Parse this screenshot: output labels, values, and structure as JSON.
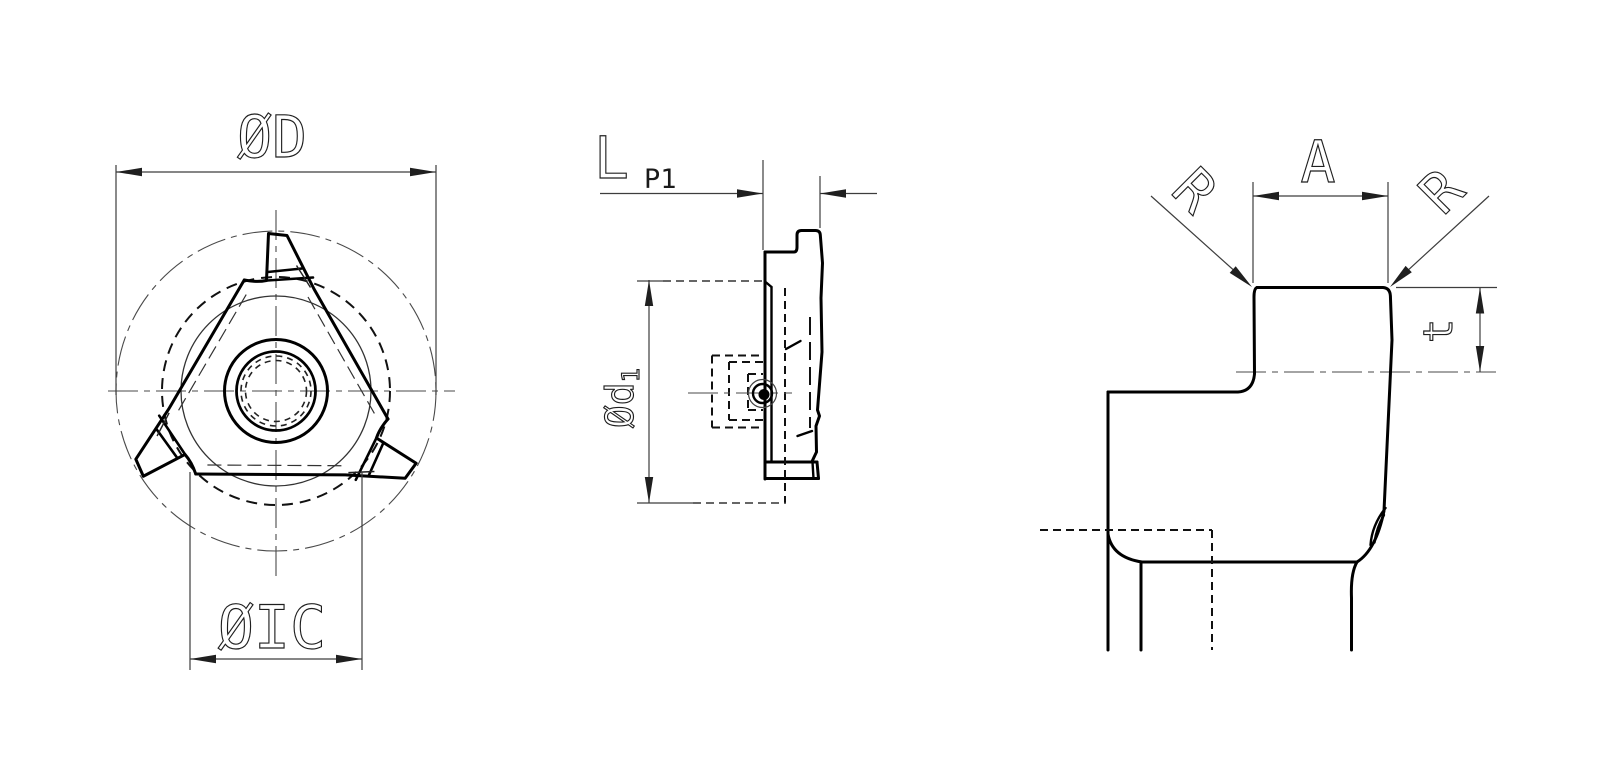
{
  "drawing": {
    "background": "#ffffff",
    "ink_color": "#000000",
    "thin_line_color": "#444444",
    "views": {
      "front_view": {
        "dim_outer_diameter": "ØD",
        "dim_inscribed_circle": "ØIC"
      },
      "side_view": {
        "dim_length": "L",
        "dim_tip_offset": "P1",
        "dim_hole_circle_prefix": "Ød",
        "dim_hole_circle_subscript": "1"
      },
      "tooth_detail_view": {
        "dim_tip_width": "A",
        "dim_corner_radius_left": "R",
        "dim_corner_radius_right": "R",
        "dim_tooth_depth": "t"
      }
    }
  }
}
